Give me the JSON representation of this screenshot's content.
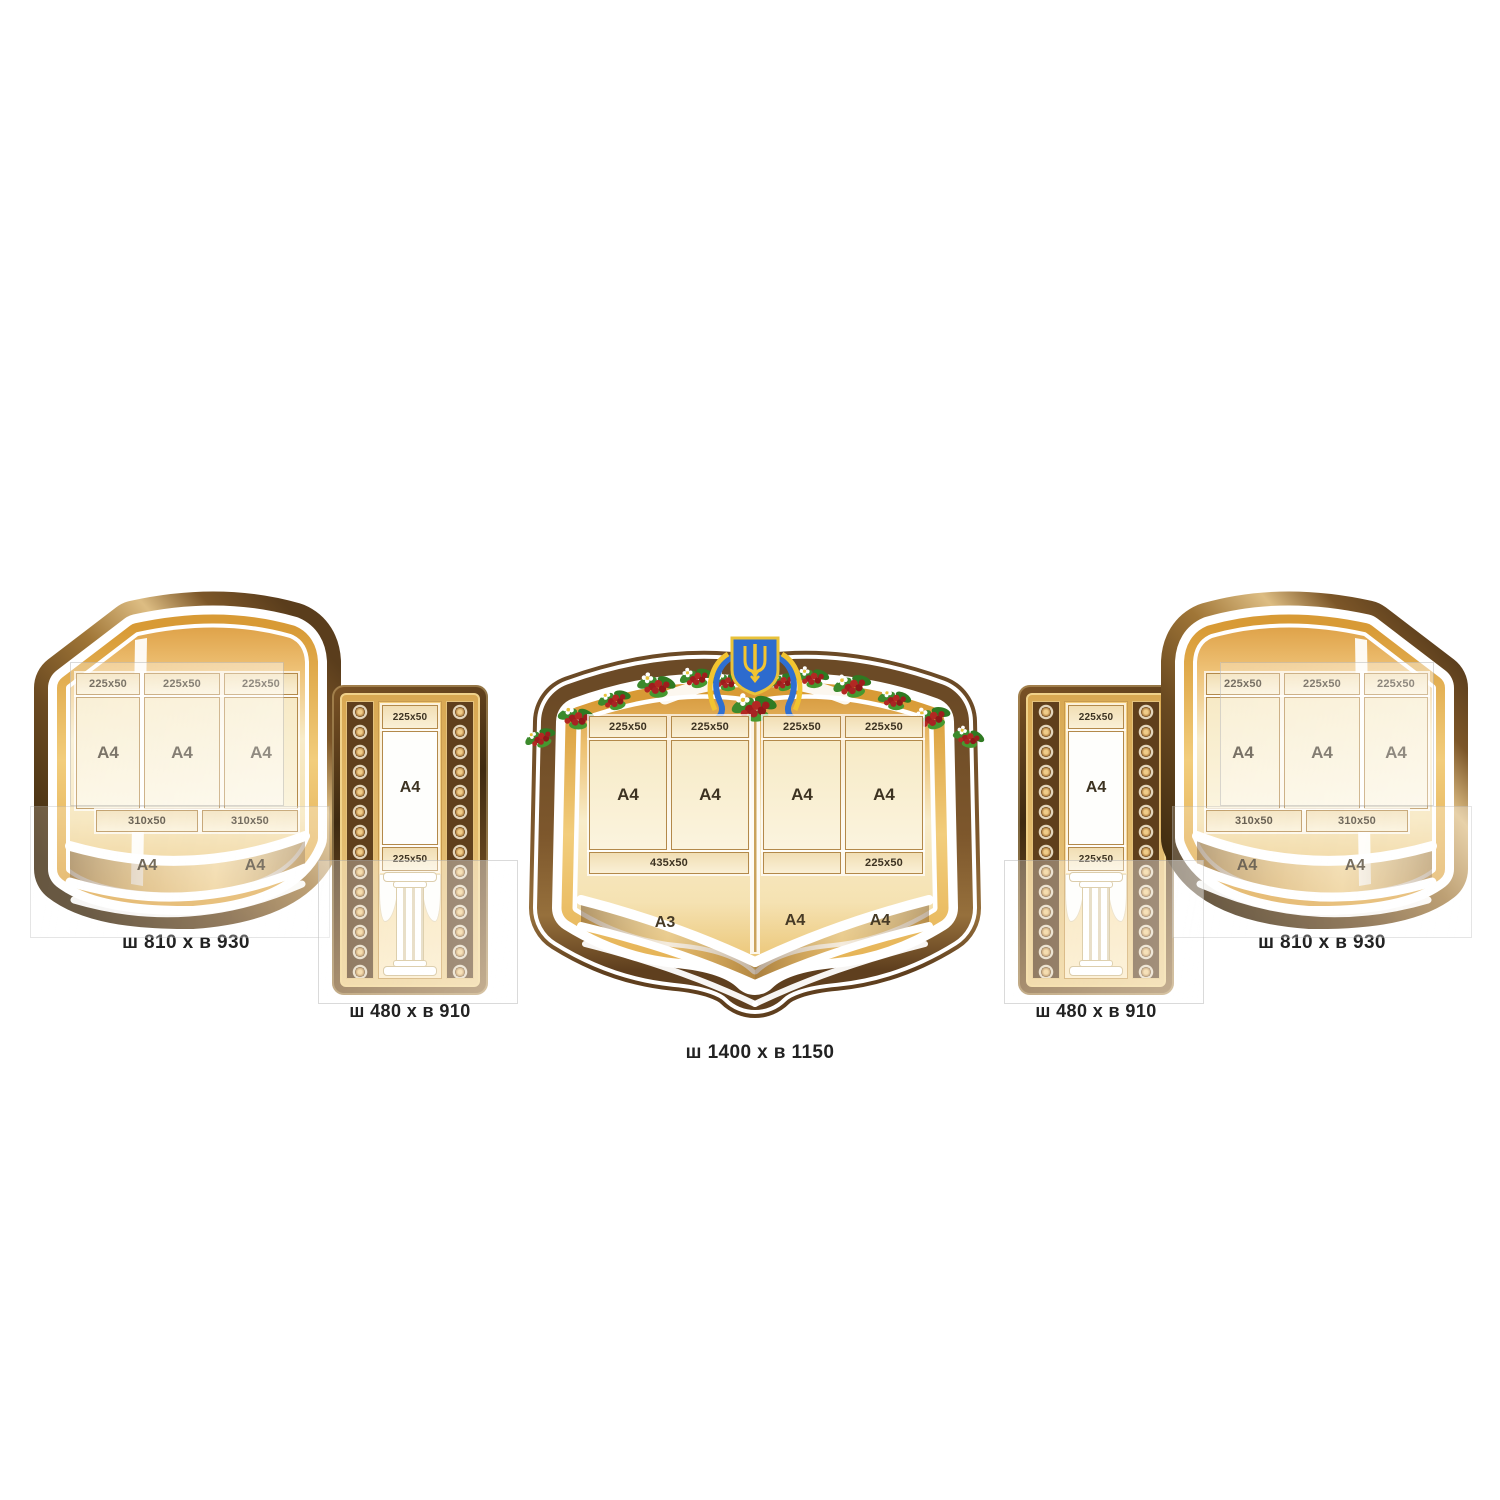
{
  "stands": {
    "book_left": {
      "label": "ш 810 х в 930",
      "headers": [
        "225x50",
        "225x50",
        "225x50"
      ],
      "a4_pockets": [
        "A4",
        "A4",
        "A4"
      ],
      "strips": [
        "310x50",
        "310x50"
      ],
      "page_bottom": [
        "A4",
        "A4"
      ]
    },
    "column_left": {
      "label": "ш 480 х в 910",
      "top_pocket": "225x50",
      "a4_pocket": "A4",
      "bottom_pocket": "225x50"
    },
    "book_center": {
      "label": "ш 1400 х в 1150",
      "left_page": {
        "headers": [
          "225x50",
          "225x50"
        ],
        "a4_pockets": [
          "A4",
          "A4"
        ],
        "strip": "435x50",
        "page_bottom": "A3"
      },
      "right_page": {
        "headers": [
          "225x50",
          "225x50"
        ],
        "a4_pockets": [
          "A4",
          "A4"
        ],
        "strip_left": "",
        "strip_right": "225x50",
        "page_bottom": [
          "A4",
          "A4"
        ]
      }
    },
    "column_right": {
      "label": "ш 480 х в 910",
      "top_pocket": "225x50",
      "a4_pocket": "A4",
      "bottom_pocket": "225x50"
    },
    "book_right": {
      "label": "ш 810 х в 930",
      "headers": [
        "225x50",
        "225x50",
        "225x50"
      ],
      "a4_pockets": [
        "A4",
        "A4",
        "A4"
      ],
      "strips": [
        "310x50",
        "310x50"
      ],
      "page_bottom": [
        "A4",
        "A4"
      ]
    }
  },
  "icons": {
    "emblem": "ukraine-trident-coat-of-arms",
    "garland": "viburnum-berry-garland",
    "column": "classical-column",
    "ornament": "medallion-chain-border"
  },
  "colors": {
    "background": "#ffffff",
    "bronze_dark": "#402c10",
    "bronze_light": "#ddbd83",
    "gold_band": "#f2cd7c",
    "page_gold": "#eec175",
    "page_cream": "#f8ecca",
    "pocket_cream": "#f5e8c4",
    "pocket_border": "#b3894a",
    "label_text": "#222222",
    "shield_blue": "#2f6fd0",
    "trident_gold": "#f2c430",
    "berry_red": "#a82222",
    "leaf_green": "#3c8a2c"
  }
}
